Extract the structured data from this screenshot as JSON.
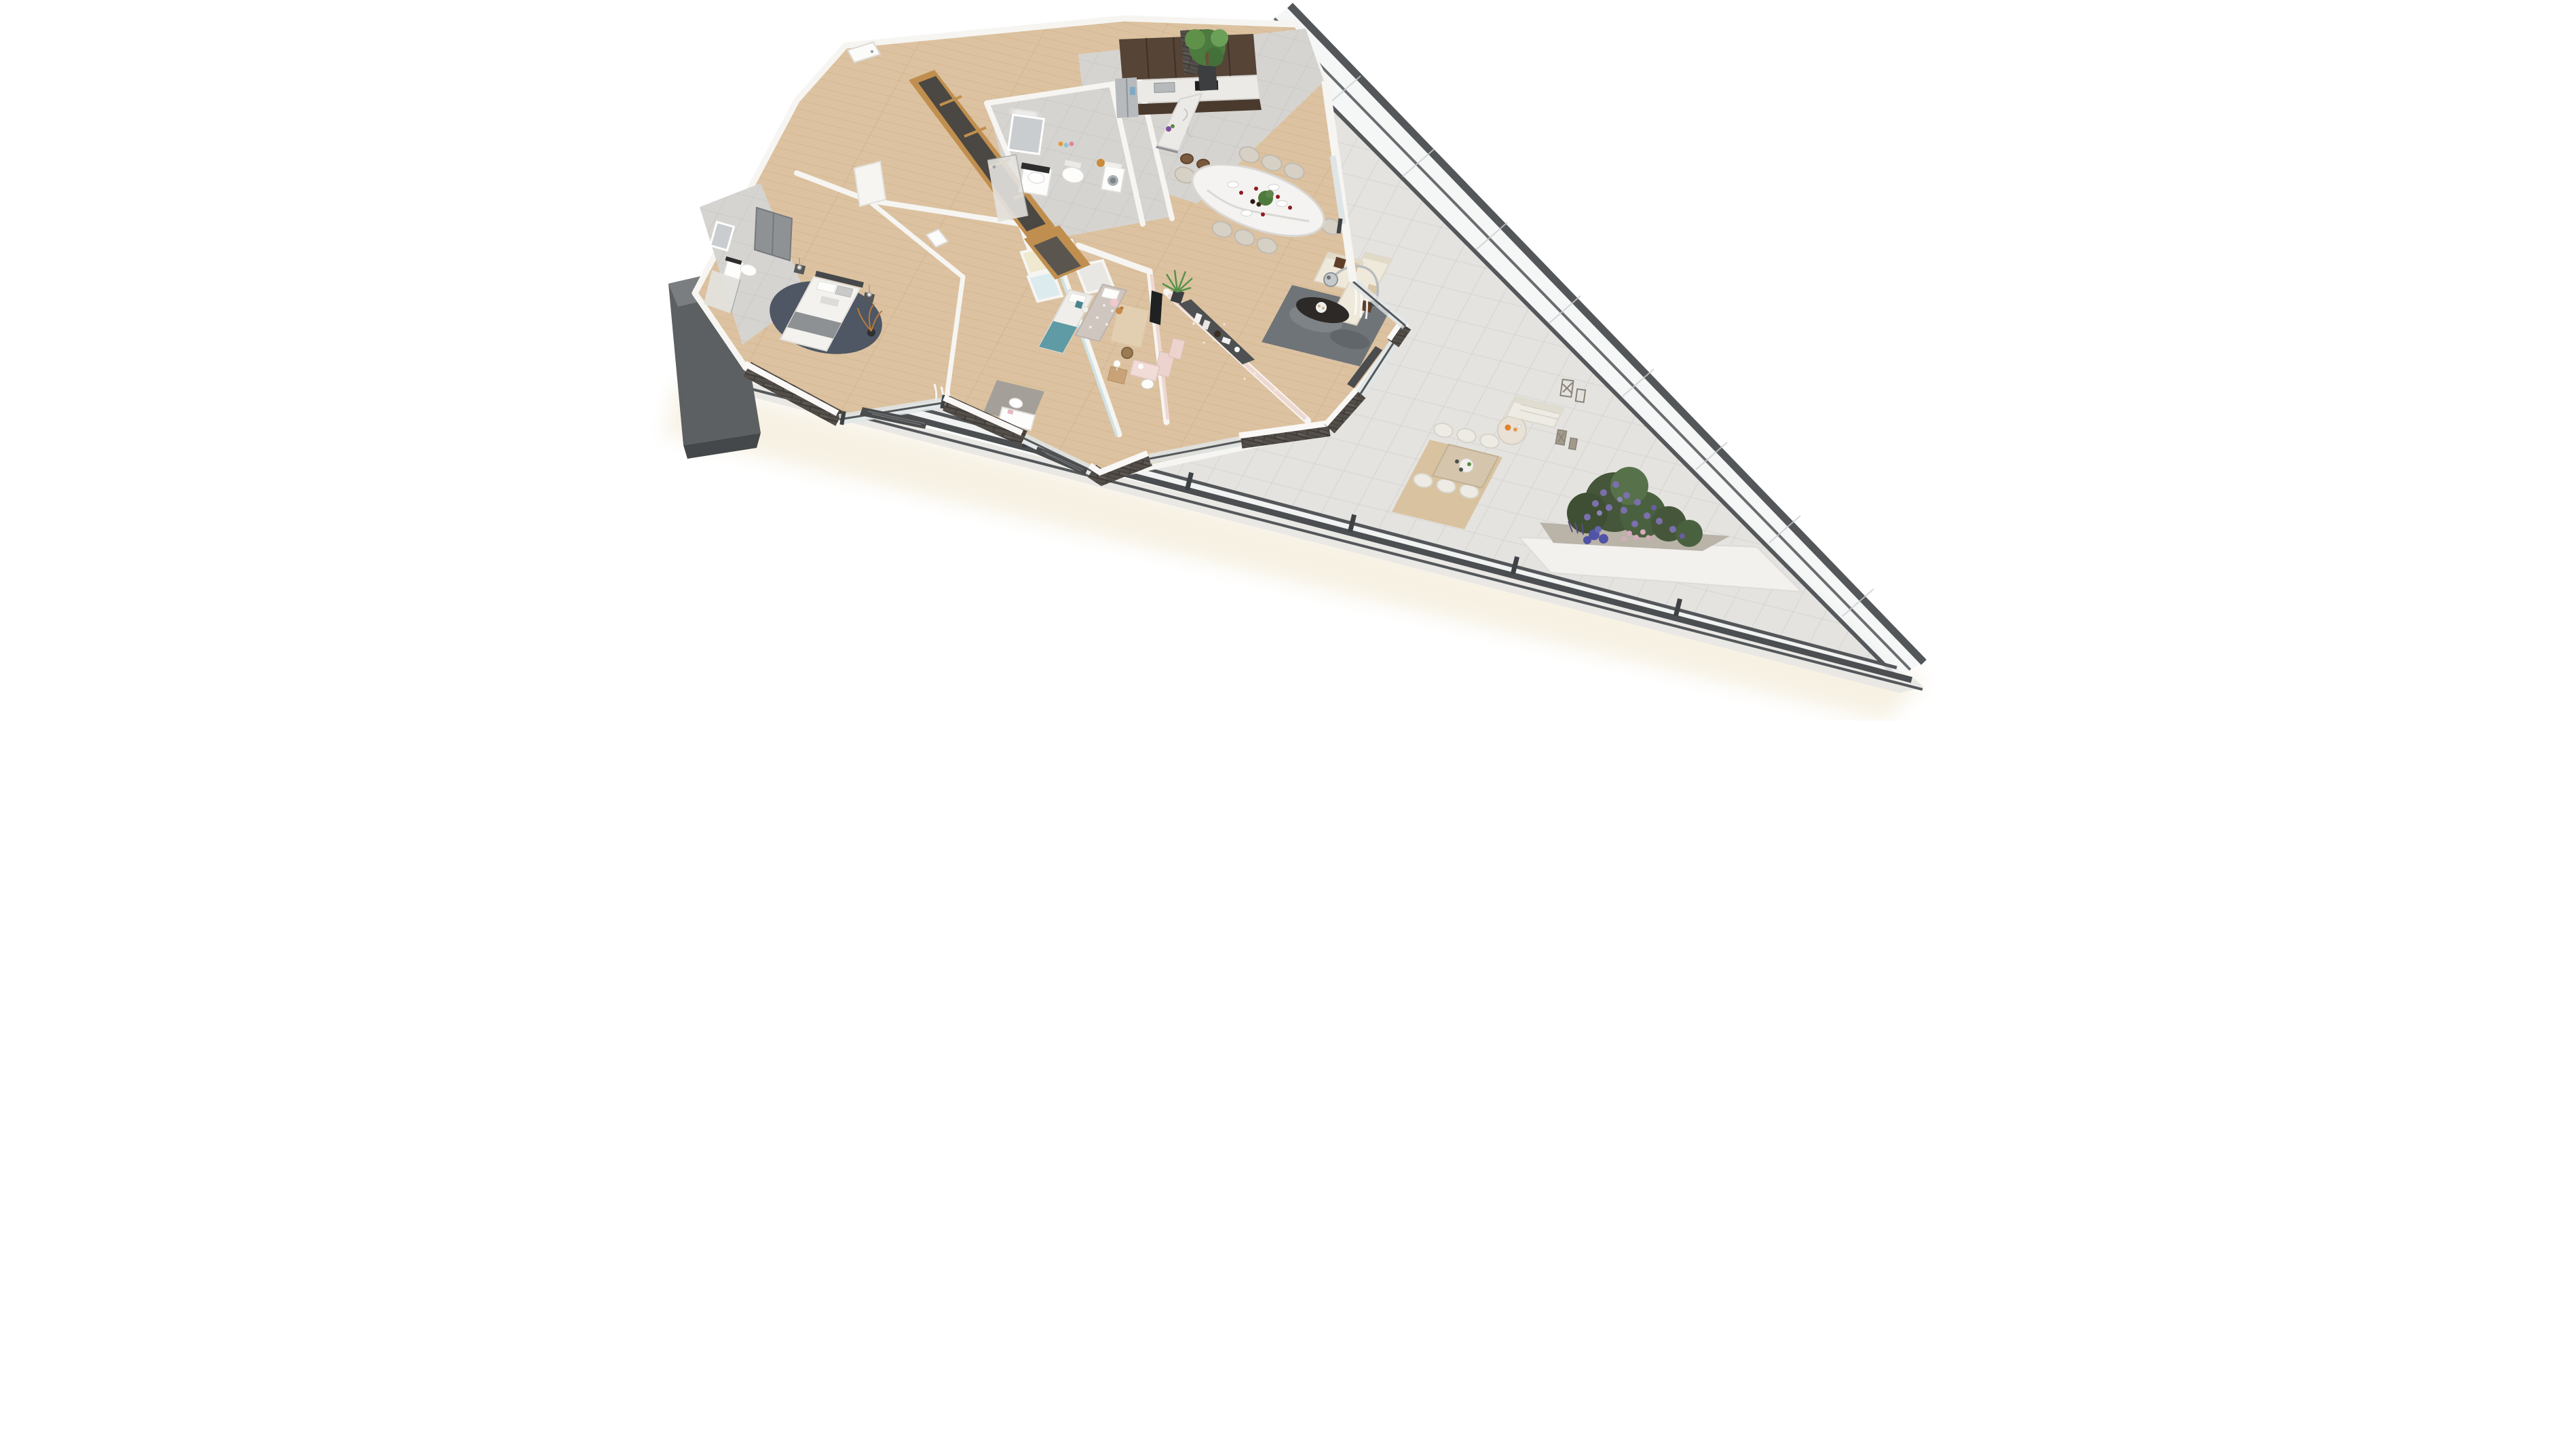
{
  "scene": {
    "kind": "3d-floor-plan-render",
    "view": "aerial-isometric",
    "background": "#ffffff",
    "footprint": "triangular wedge apartment with wrap-around glazed terrace",
    "visible_text": "none"
  },
  "palette": {
    "terrace_tile": "#e4e3e0",
    "tile_line": "#d2d0cc",
    "wood_floor": "#dcc2a0",
    "wood_line": "#ccae88",
    "interior_tile": "#d6d4d0",
    "wall_white": "#f6f5f2",
    "brick_dark": "#534e49",
    "glass_frame": "#55585b",
    "glass_tint": "#eef1f1",
    "oak_wood": "#c08f4f",
    "wardrobe_door": "#4b4742",
    "cabinet_dark": "#564437",
    "marble": "#eceae6",
    "steel": "#b7babc",
    "sofa_cream": "#efe9db",
    "rug_living": "#6f7478",
    "coffee_table_black": "#2c2927",
    "dining_chair_beige": "#d7d0c5",
    "wine_red": "#8e1c22",
    "plant_green": "#4e7a3c",
    "bed_throw_gray": "#8e9194",
    "master_rug_navy": "#4e5763",
    "teal_accent": "#5f9ba4",
    "blue_room_wall": "#cfe3e7",
    "pink_room_wall": "#efd7d1",
    "kids_rug_beige": "#e2cfb2",
    "outdoor_rug": "#d8c09b",
    "outdoor_wood": "#d5c5ac",
    "wicker_white": "#edebe3",
    "flower_purple": "#7b70ad",
    "flower_blue": "#5153a5",
    "flower_pink": "#d7abbc",
    "leaf_dark": "#45563a",
    "juice_orange": "#df832e",
    "building_core_gray": "#5d6062"
  },
  "rooms": [
    {
      "id": "entrance-hall",
      "name": "Entrance hall",
      "floor": "wood",
      "furniture": [
        "white front door",
        "oak-framed wardrobe with five smoked-glass doors",
        "oak low cabinet",
        "white interior doors"
      ]
    },
    {
      "id": "main-bathroom",
      "name": "Main bathroom",
      "floor": "gray tile",
      "furniture": [
        "illuminated mirror",
        "vanity washbasin with black counter",
        "wall-hung toilet",
        "walk-in shower with glass screen",
        "niche with colorful toiletry bottles",
        "washing machine with towels on top",
        "wooden hamper"
      ]
    },
    {
      "id": "kitchen",
      "name": "Kitchen",
      "floor": "gray tile",
      "furniture": [
        "dark wood upper and lower cabinets",
        "marble countertop with double sink",
        "black cooktop",
        "built-in oven",
        "side-by-side stainless fridge",
        "brick accent wall",
        "tall planter with green tree",
        "marble bar island",
        "two wooden bar stools"
      ]
    },
    {
      "id": "dining-area",
      "name": "Dining area",
      "floor": "wood",
      "furniture": [
        "white marble dining table",
        "eight beige upholstered chairs",
        "six glasses of red wine",
        "two wine bottles",
        "potted plant centerpiece",
        "place settings"
      ]
    },
    {
      "id": "living-room",
      "name": "Living room",
      "floor": "wood",
      "furniture": [
        "cream L-shaped sectional sofa",
        "brown and beige cushions",
        "chrome arc floor lamp with perforated dome",
        "black oval coffee table with candle tray",
        "mottled gray rug",
        "wall-mounted TV",
        "dark console shelf with books and vases",
        "sheer curtains",
        "sliding glass doors",
        "brick piers with white caps"
      ]
    },
    {
      "id": "master-bedroom",
      "name": "Master bedroom",
      "floor": "wood",
      "furniture": [
        "upholstered double bed with white duvet and gray runner",
        "two nightstands with pendant bulbs",
        "round navy rug",
        "gray built-in wardrobe doors",
        "copper decorative branches in vase",
        "window curtain"
      ]
    },
    {
      "id": "master-ensuite",
      "name": "Master ensuite",
      "floor": "gray tile",
      "furniture": [
        "walk-in shower",
        "vanity washbasin",
        "mirror with light",
        "wall-hung toilet"
      ]
    },
    {
      "id": "kids-bedroom-blue",
      "name": "Kids bedroom (blue)",
      "floor": "wood",
      "furniture": [
        "single bed with teal throw",
        "teal chevron cushions",
        "plush toy",
        "gray rug",
        "white desk with chair at window",
        "walk-in closet cells in cream and pale blue"
      ]
    },
    {
      "id": "kids-bedroom-pink",
      "name": "Kids bedroom (pink)",
      "floor": "wood",
      "furniture": [
        "upholstered single bed with diamond-pattern duvet",
        "pink cushion",
        "teddy bear",
        "star-pattern pink walls",
        "beige rug",
        "pink desk with white chair",
        "pink bookshelf",
        "rattan basket",
        "dresser with table lamp",
        "yucca plant in dark planter"
      ]
    }
  ],
  "terrace": {
    "name": "Wrap-around terrace",
    "floor": "light porcelain tiles",
    "furniture": [
      "light-wood outdoor dining table",
      "six white wicker chairs",
      "beige outdoor rug",
      "round cream coffee table with orange juice carafe and glasses",
      "white wicker sofa",
      "two wooden candle lanterns",
      "raised white planter with purple rhododendron, blue hydrangeas, pink roses and lavender",
      "corner brick planter with green shrub",
      "floor radiator grilles along windows"
    ],
    "perimeter": "glass balustrade with anthracite rails"
  },
  "facade": {
    "type": "outward-leaning glass curtain wall",
    "frame_color": "#55585b",
    "runs": "full diagonal edge from north corner to east tip"
  },
  "building_core": {
    "type": "dark gray service wall wedge",
    "position": "west corner"
  }
}
